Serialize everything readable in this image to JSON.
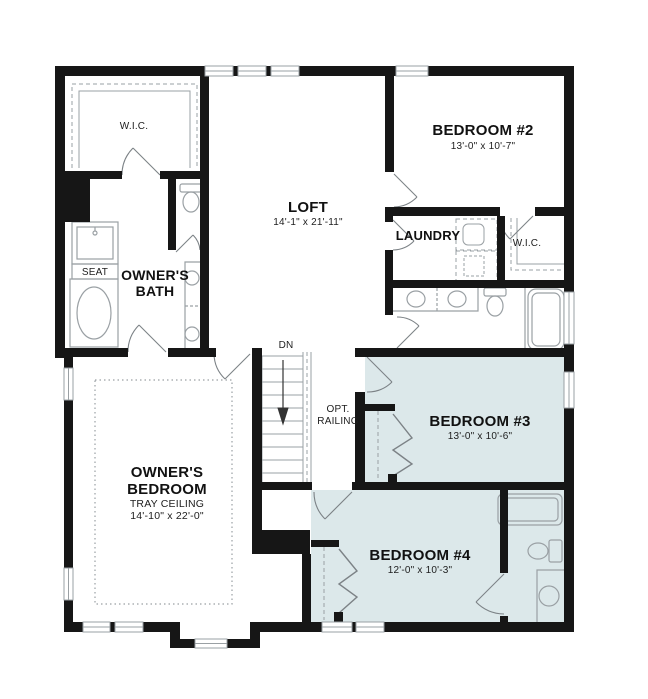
{
  "plan_type": "second-floor residential floor plan",
  "colors": {
    "wall": "#161616",
    "highlight_room": "#dce8ea",
    "fixture_line": "#9aa0a4",
    "text": "#111111"
  },
  "rooms": {
    "owners_wic": {
      "label": "W.I.C."
    },
    "loft": {
      "label": "LOFT",
      "dims": "14'-1\" x 21'-11\""
    },
    "bedroom2": {
      "label": "BEDROOM #2",
      "dims": "13'-0\" x 10'-7\""
    },
    "laundry": {
      "label": "LAUNDRY"
    },
    "bedroom2_wic": {
      "label": "W.I.C."
    },
    "owners_bath": {
      "label": "OWNER'S BATH"
    },
    "shower_seat": {
      "label": "SEAT"
    },
    "stairs": {
      "label": "DN"
    },
    "railing_note": {
      "label": "OPT. RAILING"
    },
    "bedroom3": {
      "label": "BEDROOM #3",
      "dims": "13'-0\" x 10'-6\""
    },
    "owners_bedroom": {
      "label": "OWNER'S BEDROOM",
      "note": "TRAY CEILING",
      "dims": "14'-10\" x 22'-0\""
    },
    "bedroom4": {
      "label": "BEDROOM #4",
      "dims": "12'-0\" x 10'-3\""
    }
  }
}
